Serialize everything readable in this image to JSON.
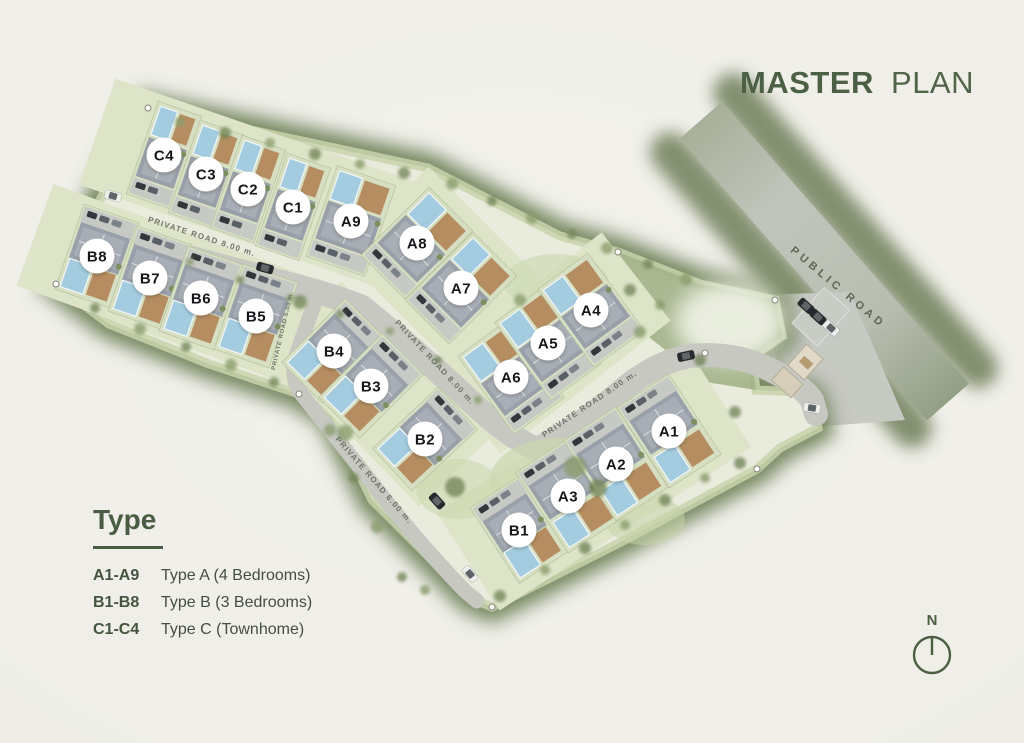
{
  "title": {
    "bold": "MASTER",
    "light": "PLAN"
  },
  "legend": {
    "heading": "Type",
    "items": [
      {
        "code": "A1-A9",
        "label": "Type A (4 Bedrooms)"
      },
      {
        "code": "B1-B8",
        "label": "Type B (3 Bedrooms)"
      },
      {
        "code": "C1-C4",
        "label": "Type C (Townhome)"
      }
    ]
  },
  "north": {
    "label": "N"
  },
  "colors": {
    "accent_green": "#4a5d44",
    "map_border_green": "#75865f",
    "road_gray": "#c6c8c1",
    "pool_blue": "#a3cce1",
    "grass_light": "#dde4c8",
    "road_label_gray": "#6f746a",
    "public_road_label": "#5d6853",
    "label_circle_fill": "#ffffff",
    "label_text": "#151619"
  },
  "plan": {
    "units": [
      {
        "id": "C4",
        "type": "C",
        "x": 164,
        "y": 155,
        "angle": 19,
        "pool": "top"
      },
      {
        "id": "C3",
        "type": "C",
        "x": 206,
        "y": 174,
        "angle": 19,
        "pool": "top"
      },
      {
        "id": "C2",
        "type": "C",
        "x": 248,
        "y": 189,
        "angle": 19,
        "pool": "top"
      },
      {
        "id": "C1",
        "type": "C",
        "x": 293,
        "y": 207,
        "angle": 19,
        "pool": "top"
      },
      {
        "id": "A9",
        "type": "A",
        "x": 351,
        "y": 221,
        "angle": 19,
        "pool": "top"
      },
      {
        "id": "A8",
        "type": "A",
        "x": 417,
        "y": 243,
        "angle": 45,
        "pool": "top"
      },
      {
        "id": "A7",
        "type": "A",
        "x": 461,
        "y": 288,
        "angle": 45,
        "pool": "top"
      },
      {
        "id": "B8",
        "type": "B",
        "x": 97,
        "y": 256,
        "angle": 19,
        "pool": "bottom"
      },
      {
        "id": "B7",
        "type": "B",
        "x": 150,
        "y": 278,
        "angle": 19,
        "pool": "bottom"
      },
      {
        "id": "B6",
        "type": "B",
        "x": 201,
        "y": 298,
        "angle": 19,
        "pool": "bottom"
      },
      {
        "id": "B5",
        "type": "B",
        "x": 256,
        "y": 316,
        "angle": 19,
        "pool": "bottom"
      },
      {
        "id": "B4",
        "type": "B",
        "x": 334,
        "y": 351,
        "angle": 45,
        "pool": "bottom"
      },
      {
        "id": "B3",
        "type": "B",
        "x": 371,
        "y": 386,
        "angle": 45,
        "pool": "bottom"
      },
      {
        "id": "B2",
        "type": "B",
        "x": 425,
        "y": 439,
        "angle": 47,
        "pool": "bottom"
      },
      {
        "id": "A6",
        "type": "A",
        "x": 511,
        "y": 377,
        "angle": -36,
        "pool": "top"
      },
      {
        "id": "A5",
        "type": "A",
        "x": 548,
        "y": 343,
        "angle": -36,
        "pool": "top"
      },
      {
        "id": "A4",
        "type": "A",
        "x": 591,
        "y": 310,
        "angle": -36,
        "pool": "top"
      },
      {
        "id": "B1",
        "type": "B",
        "x": 519,
        "y": 530,
        "angle": -33,
        "pool": "bottom"
      },
      {
        "id": "A3",
        "type": "A",
        "x": 568,
        "y": 496,
        "angle": -33,
        "pool": "bottom"
      },
      {
        "id": "A2",
        "type": "A",
        "x": 616,
        "y": 464,
        "angle": -33,
        "pool": "bottom"
      },
      {
        "id": "A1",
        "type": "A",
        "x": 669,
        "y": 431,
        "angle": -33,
        "pool": "bottom"
      }
    ],
    "unit_types": {
      "A": {
        "w": 62,
        "h": 96
      },
      "B": {
        "w": 58,
        "h": 90
      },
      "C": {
        "w": 46,
        "h": 98
      }
    },
    "road_labels": [
      {
        "text": "PRIVATE ROAD 8.00 m.",
        "x": 201,
        "y": 239,
        "angle": 18,
        "size": 8,
        "spacing": 1.2,
        "kind": "private"
      },
      {
        "text": "PRIVATE ROAD 5.00 m.",
        "x": 284,
        "y": 331,
        "angle": -77,
        "size": 6,
        "spacing": 0.7,
        "kind": "private"
      },
      {
        "text": "PRIVATE ROAD 8.00 m.",
        "x": 433,
        "y": 364,
        "angle": 47,
        "size": 8,
        "spacing": 1.2,
        "kind": "private"
      },
      {
        "text": "PRIVATE ROAD 8.00 m.",
        "x": 591,
        "y": 406,
        "angle": -34,
        "size": 8,
        "spacing": 1.2,
        "kind": "private"
      },
      {
        "text": "PRIVATE ROAD 6.00 m.",
        "x": 372,
        "y": 482,
        "angle": 49,
        "size": 8,
        "spacing": 1.2,
        "kind": "private"
      },
      {
        "text": "PUBLIC ROAD",
        "x": 836,
        "y": 290,
        "angle": 40,
        "size": 11,
        "spacing": 4,
        "kind": "public"
      }
    ],
    "decorations": {
      "cars": [
        {
          "x": 113,
          "y": 196,
          "angle": 16,
          "light": true
        },
        {
          "x": 265,
          "y": 268,
          "angle": 16,
          "light": false
        },
        {
          "x": 437,
          "y": 501,
          "angle": 48,
          "light": false
        },
        {
          "x": 470,
          "y": 574,
          "angle": 50,
          "light": true
        },
        {
          "x": 686,
          "y": 356,
          "angle": -12,
          "light": false
        },
        {
          "x": 812,
          "y": 408,
          "angle": 10,
          "light": true
        },
        {
          "x": 806,
          "y": 306,
          "angle": 42,
          "light": false
        },
        {
          "x": 818,
          "y": 317,
          "angle": 42,
          "light": false
        },
        {
          "x": 831,
          "y": 328,
          "angle": 42,
          "light": true
        }
      ],
      "trees": [
        [
          180,
          122,
          5
        ],
        [
          225,
          133,
          6
        ],
        [
          270,
          143,
          5
        ],
        [
          315,
          154,
          6
        ],
        [
          360,
          164,
          5
        ],
        [
          404,
          173,
          6
        ],
        [
          452,
          184,
          6
        ],
        [
          492,
          201,
          5
        ],
        [
          532,
          218,
          6
        ],
        [
          572,
          234,
          5
        ],
        [
          607,
          248,
          6
        ],
        [
          648,
          264,
          5
        ],
        [
          686,
          279,
          6
        ],
        [
          95,
          308,
          5
        ],
        [
          140,
          329,
          6
        ],
        [
          186,
          347,
          5
        ],
        [
          231,
          365,
          6
        ],
        [
          274,
          382,
          5
        ],
        [
          330,
          430,
          6
        ],
        [
          354,
          478,
          5
        ],
        [
          377,
          527,
          6
        ],
        [
          402,
          577,
          5
        ],
        [
          425,
          590,
          5
        ],
        [
          500,
          596,
          6
        ],
        [
          545,
          570,
          5
        ],
        [
          585,
          548,
          6
        ],
        [
          625,
          525,
          5
        ],
        [
          665,
          500,
          6
        ],
        [
          705,
          478,
          5
        ],
        [
          740,
          463,
          6
        ],
        [
          575,
          467,
          11
        ],
        [
          598,
          488,
          9
        ],
        [
          622,
          470,
          7
        ],
        [
          455,
          487,
          10
        ],
        [
          345,
          433,
          8
        ],
        [
          300,
          302,
          7
        ],
        [
          520,
          300,
          6
        ],
        [
          700,
          360,
          6
        ],
        [
          640,
          332,
          6
        ],
        [
          735,
          412,
          6
        ],
        [
          190,
          262,
          4
        ],
        [
          240,
          280,
          4
        ],
        [
          290,
          298,
          4
        ],
        [
          340,
          314,
          4
        ],
        [
          390,
          331,
          4
        ],
        [
          438,
          360,
          4
        ],
        [
          478,
          400,
          4
        ],
        [
          630,
          290,
          6
        ],
        [
          660,
          305,
          5
        ]
      ],
      "survey_points": [
        [
          148,
          108
        ],
        [
          56,
          284
        ],
        [
          299,
          394
        ],
        [
          492,
          607
        ],
        [
          757,
          469
        ],
        [
          618,
          252
        ],
        [
          705,
          353
        ],
        [
          775,
          300
        ]
      ]
    }
  }
}
